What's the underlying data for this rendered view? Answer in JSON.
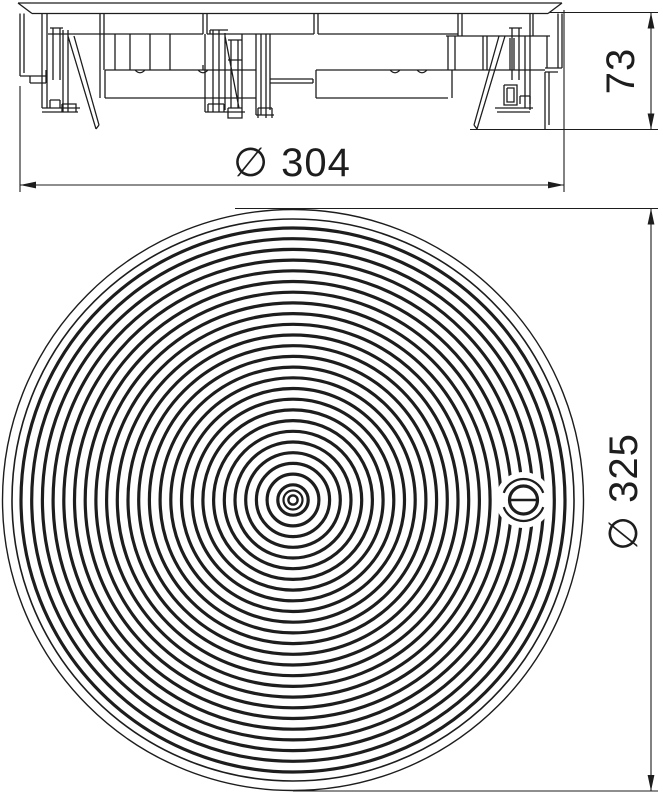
{
  "page": {
    "background": "#ffffff",
    "line_color": "#1d1d1d",
    "description": "Technical dimension drawing: round floor-box cassette, side elevation above, plan view of ribbed round cover below"
  },
  "views": {
    "side_view": {
      "name": "side-elevation",
      "description": "Sectional side view of round cassette with flange, hanging mounting latches and diagonal support legs"
    },
    "plan_view": {
      "name": "plan-view",
      "description": "Round cover plate with concentric anti-slip ribs and one slotted fixing screw"
    }
  },
  "dimensions": {
    "width": {
      "symbol": "∅",
      "value": 304,
      "label": "∅ 304"
    },
    "height": {
      "value": 73,
      "label": "73"
    },
    "outer_diameter": {
      "symbol": "∅",
      "value": 325,
      "label": "∅ 325"
    }
  },
  "plan_view_geometry": {
    "center_x": 293,
    "center_y": 500,
    "outer_radius": 290.5,
    "outer_stroke": 1.4,
    "inner_edge_radius": 281,
    "inner_edge_stroke": 1.6,
    "rib_outer_start": 272,
    "rib_pitch": 10.7,
    "rib_count": 25,
    "rib_stroke": 3.2,
    "extra_inner_ring_radius": 9.5,
    "extra_inner_ring_stroke": 2.2,
    "hub_radius": 4.6,
    "hub_stroke": 2.4,
    "screw": {
      "icon": "slotted-screw-head-icon",
      "x": 523.5,
      "y": 500,
      "clear_radius": 28,
      "collar_arc_radius": 21,
      "collar_stroke": 2.2,
      "head_radius": 14,
      "head_stroke": 3.2,
      "slot_half_length": 14.5,
      "slot_stroke": 2.4
    }
  }
}
